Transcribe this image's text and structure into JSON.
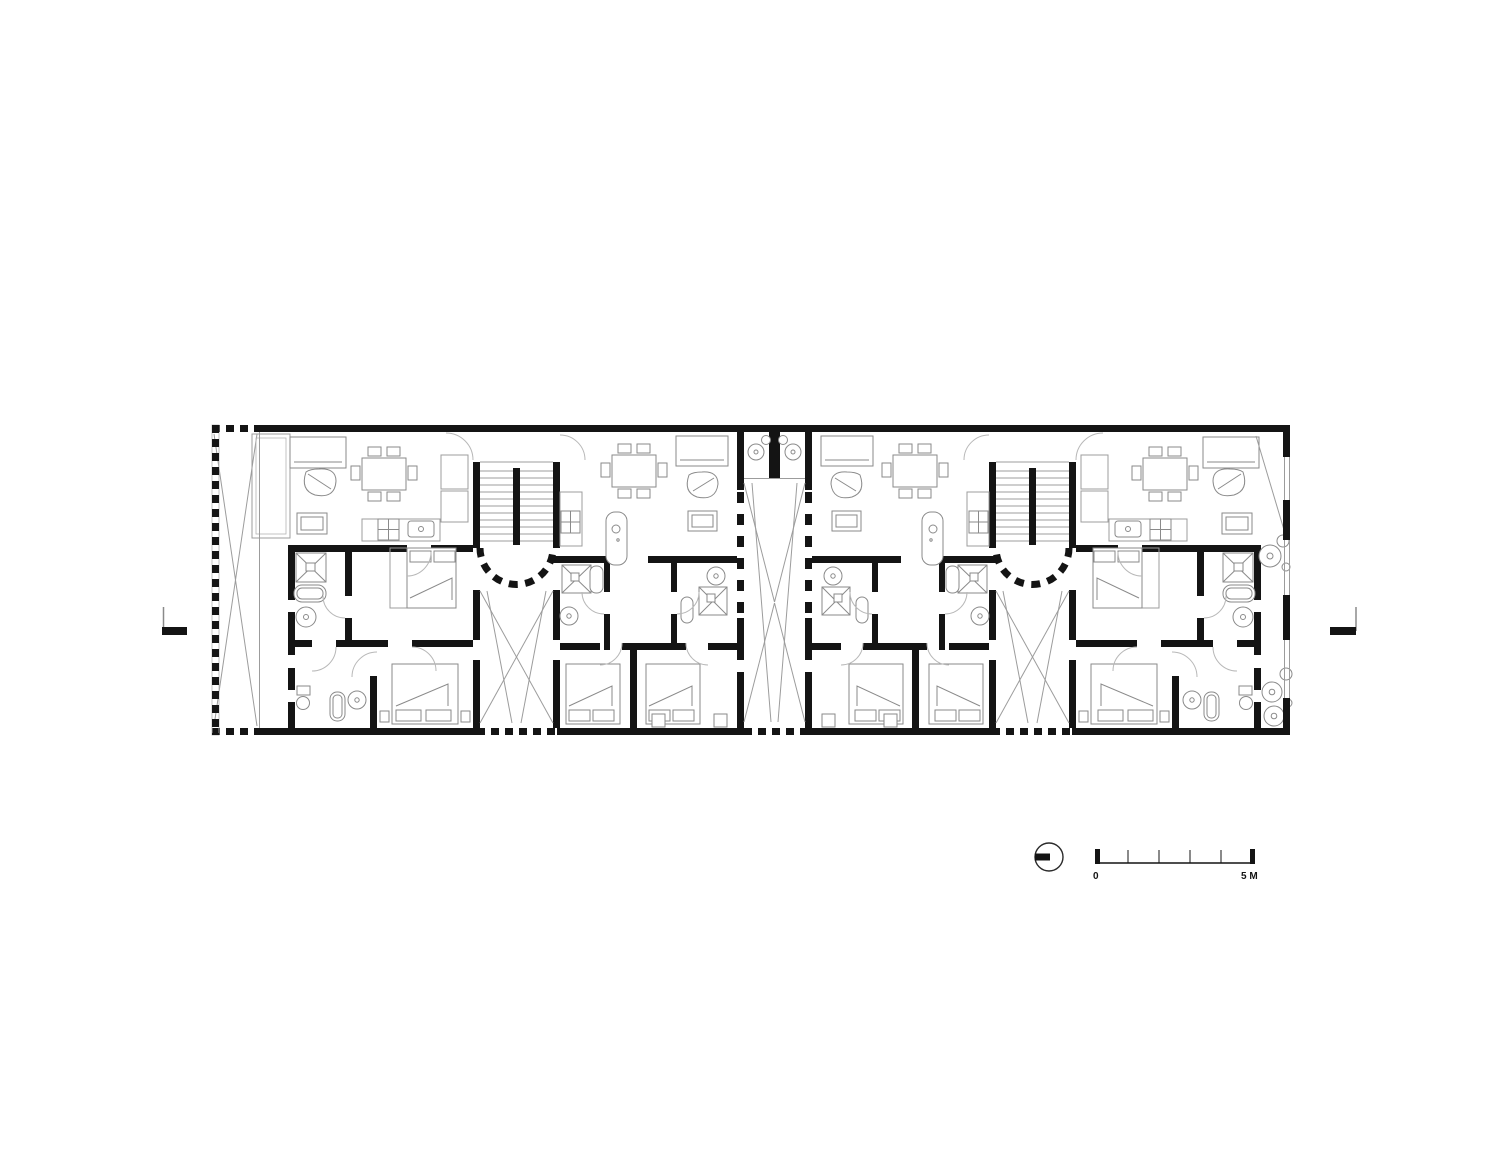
{
  "drawing": {
    "title": "residential-floor-plan",
    "scale_bar": {
      "zero_label": "0",
      "max_label": "5 M",
      "divisions": 5
    },
    "colors": {
      "background": "#ffffff",
      "walls": "#141414",
      "thin_lines": "#9c9c9c",
      "furniture_lines": "#8a8a8a",
      "door_arcs": "#b8b8b8"
    },
    "icons": [
      {
        "name": "north-arrow-icon",
        "description": "circle with solid bar pointing left"
      },
      {
        "name": "section-marker-left-icon",
        "description": "section cut mark, bar pointing right"
      },
      {
        "name": "section-marker-right-icon",
        "description": "section cut mark, bar pointing left"
      }
    ],
    "elements": {
      "units": 4,
      "stairwells": 2,
      "central_courtyard": 1,
      "left_terrace": 1,
      "dining_tables": 4,
      "beds": 8
    }
  }
}
